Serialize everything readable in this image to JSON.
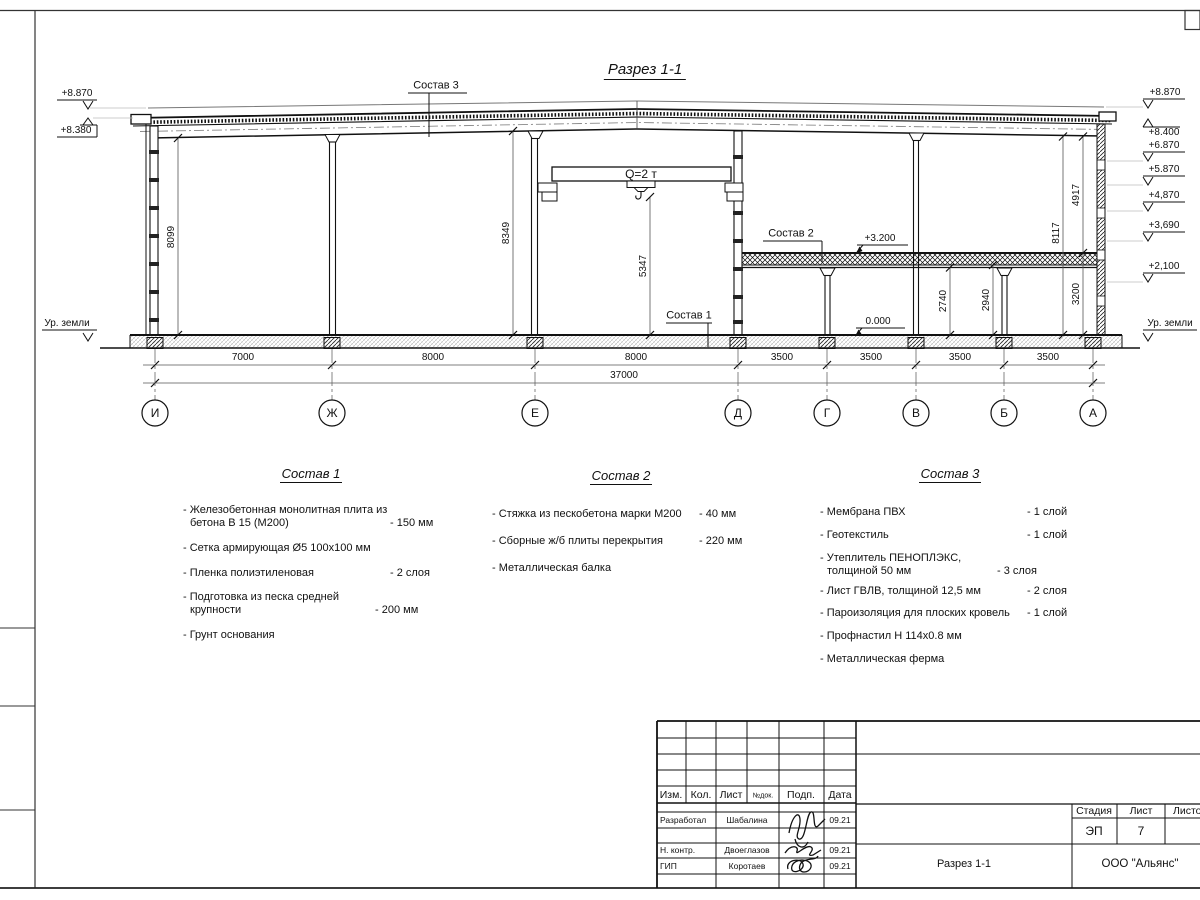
{
  "drawing": {
    "title": "Разрез 1-1",
    "crane": "Q=2 т",
    "mark_mezzanine": "+3.200",
    "mark_floor": "0.000",
    "ground_left": "Ур. земли",
    "ground_right": "Ур. земли",
    "levels_left": [
      "+8.870",
      "+8.380"
    ],
    "levels_right": [
      "+8.870",
      "+8.400",
      "+6.870",
      "+5.870",
      "+4,870",
      "+3,690",
      "+2,100"
    ],
    "vdims": {
      "hall_left": "8099",
      "hall_mid": "8349",
      "hook": "5347",
      "under_beam": "2740",
      "under_slab": "2940",
      "to_slab_top": "3200",
      "full_right": "8117",
      "above_slab": "4917"
    },
    "axes": [
      "И",
      "Ж",
      "Е",
      "Д",
      "Г",
      "В",
      "Б",
      "А"
    ],
    "spans": [
      "7000",
      "8000",
      "8000",
      "3500",
      "3500",
      "3500",
      "3500"
    ],
    "total": "37000",
    "leader1": "Состав 1",
    "leader2": "Состав 2",
    "leader3": "Состав 3"
  },
  "comp1": {
    "title": "Состав 1",
    "items": [
      {
        "name": "- Железобетонная  монолитная плита из бетона В 15 (М200)",
        "value": "- 150 мм"
      },
      {
        "name": "- Сетка армирующая Ø5 100х100 мм",
        "value": ""
      },
      {
        "name": "- Пленка полиэтиленовая",
        "value": "- 2 слоя"
      },
      {
        "name": "- Подготовка из песка средней крупности",
        "value": "- 200 мм"
      },
      {
        "name": "- Грунт основания",
        "value": ""
      }
    ]
  },
  "comp2": {
    "title": "Состав 2",
    "items": [
      {
        "name": "- Стяжка из пескобетона марки М200",
        "value": "- 40 мм"
      },
      {
        "name": "- Сборные ж/б плиты перекрытия",
        "value": "- 220 мм"
      },
      {
        "name": "- Металлическая балка",
        "value": ""
      }
    ]
  },
  "comp3": {
    "title": "Состав 3",
    "items": [
      {
        "name": "- Мембрана ПВХ",
        "value": "- 1 слой"
      },
      {
        "name": "- Геотекстиль",
        "value": "- 1 слой"
      },
      {
        "name": "- Утеплитель ПЕНОПЛЭКС, толщиной 50 мм",
        "value": "- 3 слоя"
      },
      {
        "name": "- Лист ГВЛВ, толщиной 12,5 мм",
        "value": "- 2 слоя"
      },
      {
        "name": "- Пароизоляция для плоских кровель",
        "value": "- 1 слой"
      },
      {
        "name": "- Профнастил Н 114х0.8 мм",
        "value": ""
      },
      {
        "name": "- Металлическая ферма",
        "value": ""
      }
    ]
  },
  "stamp": {
    "col_izm": "Изм.",
    "col_kol": "Кол.",
    "col_list": "Лист",
    "col_ndok": "№док.",
    "col_podp": "Подп.",
    "col_data": "Дата",
    "rows": [
      {
        "role": "Разработал",
        "name": "Шабалина",
        "date": "09.21"
      },
      {
        "role": "Н. контр.",
        "name": "Двоеглазов",
        "date": "09.21"
      },
      {
        "role": "ГИП",
        "name": "Коротаев",
        "date": "09.21"
      }
    ],
    "stage_label": "Стадия",
    "sheet_label": "Лист",
    "sheets_label": "Листов",
    "stage": "ЭП",
    "sheet_no": "7",
    "doc_name": "Разрез 1-1",
    "company": "ООО \"Альянс\""
  }
}
